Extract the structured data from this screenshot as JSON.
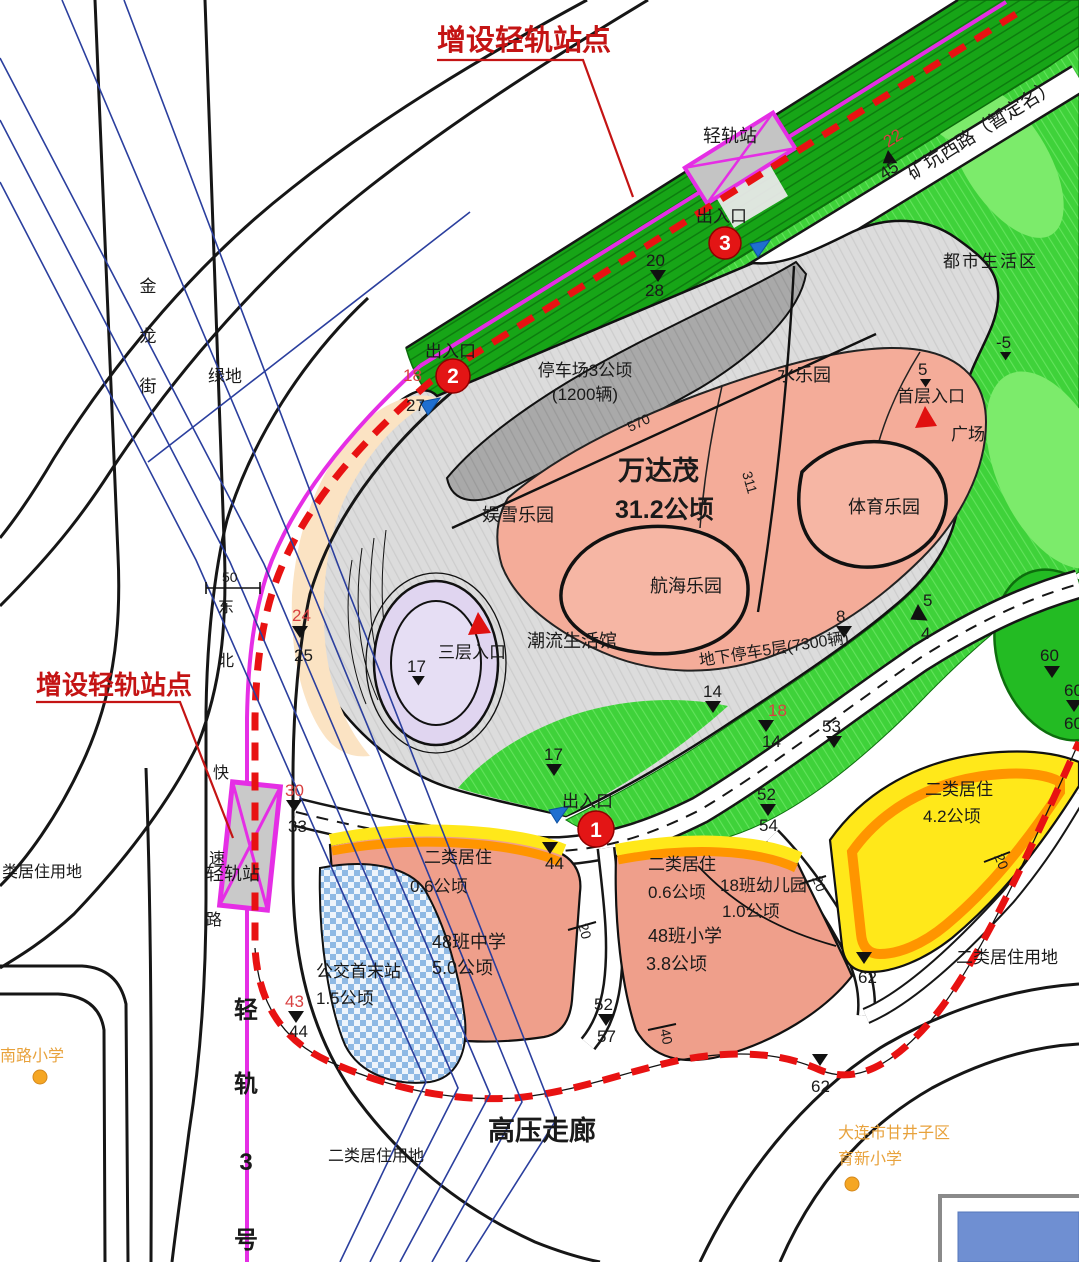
{
  "annotations": {
    "add_station_top": "增设轻轨站点",
    "add_station_left": "增设轻轨站点",
    "hv_corridor": "高压走廊",
    "rail3": [
      "轻",
      "轨",
      "3",
      "号"
    ]
  },
  "stations": {
    "top": "轻轨站",
    "left": "轻轨站"
  },
  "entrances": {
    "label1": "出入口",
    "label2": "出入口",
    "label3": "出入口",
    "n1": "1",
    "n2": "2",
    "n3": "3"
  },
  "roads": {
    "kuangkeng": "矿坑西路（暂定名）",
    "jinlong": [
      "金",
      "龙",
      "街"
    ],
    "dongbei": [
      "东",
      "北",
      "快",
      "速",
      "路"
    ]
  },
  "areas": {
    "dushi": "都市生活区",
    "parking_l1": "停车场3公顷",
    "parking_l2": "(1200辆)",
    "wanda": "万达茂",
    "wanda_area": "31.2公顷",
    "yuxue": "娱雪乐园",
    "shui": "水乐园",
    "tiyu": "体育乐园",
    "hanghai": "航海乐园",
    "chaoliu": "潮流生活馆",
    "shouceng": "首层入口",
    "guangchang": "广场",
    "sanceng": "三层入口",
    "dixia": "地下停车5层(7300辆)",
    "lvdi": "绿地",
    "residential_cut": "类居住用地",
    "gongjiao_l1": "公交首末站",
    "gongjiao_l2": "1.5公顷",
    "erju_w_l1": "二类居住",
    "erju_w_l2": "0.6公顷",
    "zhongxue_l1": "48班中学",
    "zhongxue_l2": "5.0公顷",
    "erju_m_l1": "二类居住",
    "erju_m_l2": "0.6公顷",
    "xiaoxue_l1": "48班小学",
    "xiaoxue_l2": "3.8公顷",
    "youer_l1": "18班幼儿园",
    "youer_l2": "1.0公顷",
    "erju_y_l1": "二类居住",
    "erju_y_l2": "4.2公顷",
    "erju_right": "二类居住用地",
    "erju_bottom": "二类居住用地",
    "nanlu": "南路小学",
    "yuxin_l1": "大连市甘井子区",
    "yuxin_l2": "育新小学"
  },
  "dims": {
    "m20a": "20",
    "m28": "28",
    "m45": "45",
    "m22": "22",
    "m18a": "18",
    "m27": "27",
    "m5a": "5",
    "m5neg": "-5",
    "m570": "570",
    "m311": "311",
    "m17a": "17",
    "m17b": "17",
    "m14a": "14",
    "m8": "8",
    "m5b": "5",
    "m4": "4",
    "m53": "53",
    "m18b": "18",
    "m14b": "14",
    "m60a": "60",
    "m60b": "60",
    "m60c": "60",
    "m50": "50",
    "m24": "24",
    "m25": "25",
    "m30": "30",
    "m33": "33",
    "m43": "43",
    "m44a": "44",
    "m44b": "44",
    "m52a": "52",
    "m54": "54",
    "m52b": "52",
    "m57": "57",
    "m62a": "62",
    "m62b": "62",
    "m20b": "20",
    "m20c": "20",
    "m20d": "20",
    "m40": "40"
  },
  "colors": {
    "band_green": "#17a517",
    "area_green": "#3fd23a",
    "lime": "#7ceb6b",
    "salmon": "#f4ac99",
    "parking": "#a9a9a9",
    "lavender": "#e0d5f0",
    "yellow": "#ffe81a",
    "orange": "#ff9500",
    "magenta": "#e52ee5",
    "red_dash": "#e81212",
    "blue_line": "#2b3f9e",
    "peach": "#fbe3c3"
  }
}
